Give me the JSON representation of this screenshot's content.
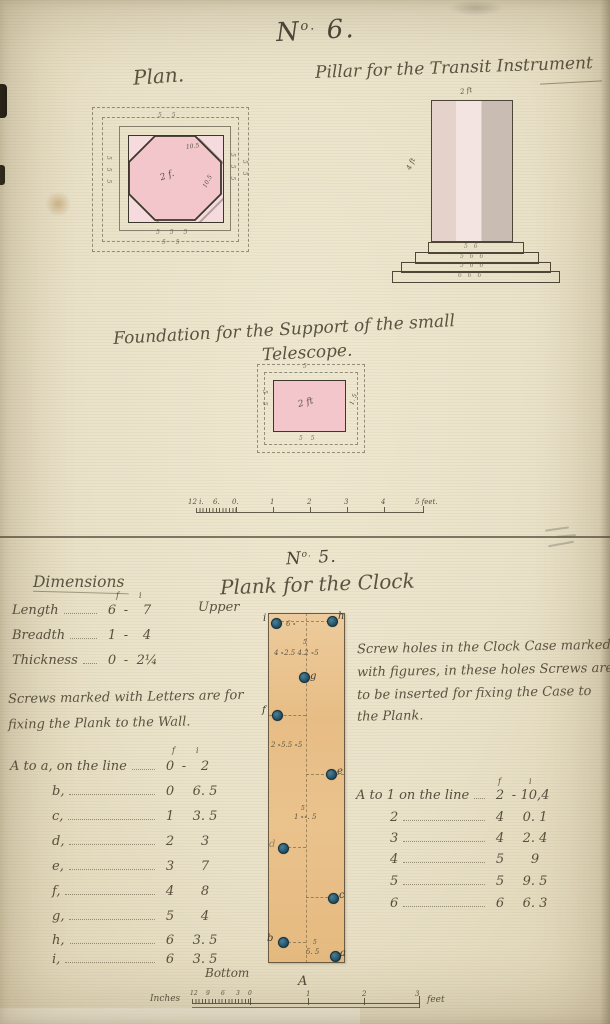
{
  "no6": {
    "title_n": "N",
    "title_sup": "o.",
    "title_num": "6.",
    "plan_label": "Plan.",
    "pillar_caption": "Pillar for the Transit Instrument",
    "plan": {
      "octagon_top_dim": "10.5",
      "octagon_center_dim": "2 f.",
      "octagon_right_dim": "10.5",
      "marks_top": "5 5",
      "marks_bottom": "5 5 5",
      "marks_bottom2": "5 5",
      "marks_left": "5 5 5",
      "marks_right": "5 5 5",
      "marks_right2": "5 5"
    },
    "pillar": {
      "top_dim": "2 ft",
      "side_dim": "4 ft",
      "step_marks": [
        "5 6",
        "5 6 6",
        "5 6 6",
        "6 6 6"
      ]
    },
    "foundation_caption_1": "Foundation for the Support of the small",
    "foundation_caption_2": "Telescope.",
    "foundation": {
      "center_dim": "2 ft",
      "right_dim": "1. 5",
      "top_mark": "5",
      "left_mark": "5 5",
      "bottom_mark": "5 5"
    },
    "scale": {
      "labels": [
        "12 i.",
        "6.",
        "0.",
        "1",
        "2",
        "3",
        "4",
        "5 feet."
      ]
    }
  },
  "no5": {
    "title_n": "N",
    "title_sup": "o.",
    "title_num": "5.",
    "subtitle": "Plank for the Clock",
    "upper_label": "Upper",
    "bottom_label": "Bottom",
    "plank_letter": "A",
    "dimensions": {
      "heading": "Dimensions",
      "col_f": "f",
      "col_i": "i",
      "rows": [
        {
          "label": "Length",
          "f": "6",
          "sep": "-",
          "i": "7"
        },
        {
          "label": "Breadth",
          "f": "1",
          "sep": "-",
          "i": "4"
        },
        {
          "label": "Thickness",
          "f": "0",
          "sep": "-",
          "i": "2¼"
        }
      ]
    },
    "wall_note_1": "Screws marked with Letters are for",
    "wall_note_2": "fixing the Plank to the Wall.",
    "case_note_1": "Screw holes in the Clock Case marked",
    "case_note_2": "with figures, in these holes Screws are",
    "case_note_3": "to be inserted for fixing the Case to",
    "case_note_4": "the Plank.",
    "left_table": {
      "col_f": "f",
      "col_i": "i",
      "rows": [
        {
          "label": "A to a, on the line",
          "f": "0",
          "sep": "-",
          "i": "2"
        },
        {
          "label": "b,",
          "f": "0",
          "sep": "",
          "i": "6. 5"
        },
        {
          "label": "c,",
          "f": "1",
          "sep": "",
          "i": "3. 5"
        },
        {
          "label": "d,",
          "f": "2",
          "sep": "",
          "i": "3"
        },
        {
          "label": "e,",
          "f": "3",
          "sep": "",
          "i": "7"
        },
        {
          "label": "f,",
          "f": "4",
          "sep": "",
          "i": "8"
        },
        {
          "label": "g,",
          "f": "5",
          "sep": "",
          "i": "4"
        },
        {
          "label": "h,",
          "f": "6",
          "sep": "",
          "i": "3. 5"
        },
        {
          "label": "i,",
          "f": "6",
          "sep": "",
          "i": "3. 5"
        }
      ]
    },
    "right_table": {
      "col_f": "f",
      "col_i": "i",
      "rows": [
        {
          "label": "A to 1 on the line",
          "f": "2",
          "sep": "-",
          "i": "10,4"
        },
        {
          "label": "2",
          "f": "4",
          "sep": "",
          "i": "0. 1"
        },
        {
          "label": "3",
          "f": "4",
          "sep": "",
          "i": "2. 4"
        },
        {
          "label": "4",
          "f": "5",
          "sep": "",
          "i": "9"
        },
        {
          "label": "5",
          "f": "5",
          "sep": "",
          "i": "9. 5"
        },
        {
          "label": "6",
          "f": "6",
          "sep": "",
          "i": "6. 3"
        }
      ]
    },
    "plank": {
      "screws": [
        {
          "label": "i"
        },
        {
          "label": "h"
        },
        {
          "label": "g"
        },
        {
          "label": "f"
        },
        {
          "label": "e"
        },
        {
          "label": "d"
        },
        {
          "label": "c"
        },
        {
          "label": "b"
        },
        {
          "label": "a"
        }
      ],
      "holes_top": "6 ∘",
      "holes_row2_sup": "5",
      "holes_row2": "4 ∘2.5  4.2 ∘5",
      "holes_row3": "2 ∘5.5  ∘5",
      "holes_row4_sup": "5",
      "holes_row4": "1 ∘∘. 5",
      "holes_bottom_sup": "5",
      "holes_bottom": "5. 5"
    },
    "scale": {
      "inches_label": "Inches",
      "feet_label": "feet",
      "block_digits": [
        "12",
        "9",
        "6",
        "3",
        "0"
      ],
      "feet_digits": [
        "1",
        "2",
        "3"
      ]
    }
  }
}
